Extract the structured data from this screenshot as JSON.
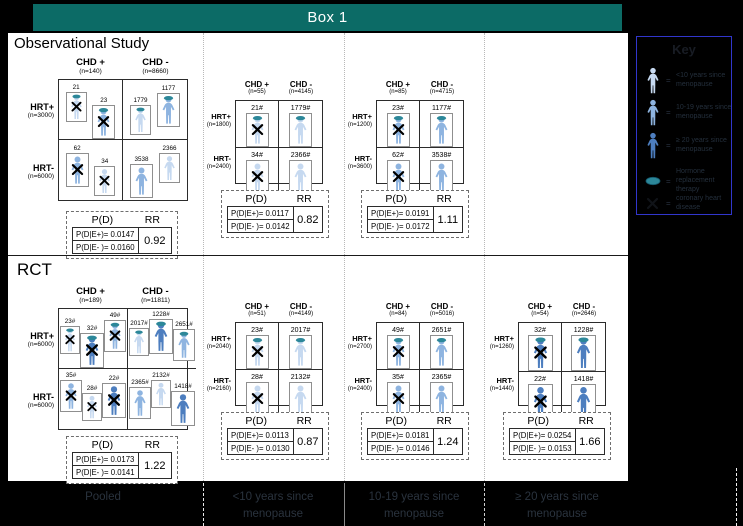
{
  "window": {
    "title": "Box 1"
  },
  "colors": {
    "header_bg": "#0c6b66",
    "person_light": "#c6d9f0",
    "person_medium": "#8eb4e0",
    "person_dark": "#4d7ebf",
    "hrt_oval": "#2c8799",
    "legend_border": "#3136cc"
  },
  "legend": {
    "title": "Key",
    "items": [
      {
        "icon": "person-light-icon",
        "shade": "light",
        "label": "<10 years since menopause"
      },
      {
        "icon": "person-medium-icon",
        "shade": "medium",
        "label": "10-19 years since menopause"
      },
      {
        "icon": "person-dark-icon",
        "shade": "dark",
        "label": "≥ 20 years since menopause"
      },
      {
        "icon": "hrt-oval-icon",
        "shade": "oval",
        "label": "Hormone replacement therapy"
      },
      {
        "icon": "chd-x-icon",
        "shade": "x",
        "label": "coronary heart disease"
      }
    ]
  },
  "sections": [
    {
      "title": "Observational Study",
      "panels": [
        {
          "columns": [
            {
              "label": "CHD +",
              "n": "(n=140)"
            },
            {
              "label": "CHD -",
              "n": "(n=8660)"
            }
          ],
          "rows": [
            {
              "label": "HRT+",
              "n": "(n=3000)"
            },
            {
              "label": "HRT-",
              "n": "(n=6000)"
            }
          ],
          "cells": [
            [
              {
                "count": "21",
                "shade": "light",
                "hat": true,
                "x": true,
                "dy": 2
              },
              {
                "count": "23",
                "shade": "medium",
                "hat": true,
                "x": true,
                "dy": 15
              }
            ],
            [
              {
                "count": "1779",
                "shade": "light",
                "hat": true,
                "x": false,
                "dy": 15
              },
              {
                "count": "1177",
                "shade": "medium",
                "hat": true,
                "x": false,
                "dy": 3
              }
            ],
            [
              {
                "count": "62",
                "shade": "medium",
                "hat": false,
                "x": true,
                "dy": 3
              },
              {
                "count": "34",
                "shade": "light",
                "hat": false,
                "x": true,
                "dy": 16
              }
            ],
            [
              {
                "count": "3538",
                "shade": "medium",
                "hat": false,
                "x": false,
                "dy": 14
              },
              {
                "count": "2366",
                "shade": "light",
                "hat": false,
                "x": false,
                "dy": 3
              }
            ]
          ],
          "table": {
            "pd": "P(D)",
            "rr": "RR",
            "row1": "P(D|E+)= 0.0147",
            "row2": "P(D|E- )= 0.0160",
            "rr_value": "0.92"
          }
        },
        {
          "columns": [
            {
              "label": "CHD +",
              "n": "(n=55)"
            },
            {
              "label": "CHD -",
              "n": "(n=4145)"
            }
          ],
          "rows": [
            {
              "label": "HRT+",
              "n": "(n=1800)"
            },
            {
              "label": "HRT-",
              "n": "(n=2400)"
            }
          ],
          "cells": [
            [
              {
                "count": "21#",
                "shade": "light",
                "hat": true,
                "x": true,
                "dy": 0
              }
            ],
            [
              {
                "count": "1779#",
                "shade": "light",
                "hat": true,
                "x": false,
                "dy": 0
              }
            ],
            [
              {
                "count": "34#",
                "shade": "light",
                "hat": false,
                "x": true,
                "dy": 0
              }
            ],
            [
              {
                "count": "2366#",
                "shade": "light",
                "hat": false,
                "x": false,
                "dy": 0
              }
            ]
          ],
          "table": {
            "pd": "P(D)",
            "rr": "RR",
            "row1": "P(D|E+)= 0.0117",
            "row2": "P(D|E- )= 0.0142",
            "rr_value": "0.82"
          }
        },
        {
          "columns": [
            {
              "label": "CHD +",
              "n": "(n=85)"
            },
            {
              "label": "CHD -",
              "n": "(n=4715)"
            }
          ],
          "rows": [
            {
              "label": "HRT+",
              "n": "(n=1200)"
            },
            {
              "label": "HRT-",
              "n": "(n=3600)"
            }
          ],
          "cells": [
            [
              {
                "count": "23#",
                "shade": "medium",
                "hat": true,
                "x": true,
                "dy": 0
              }
            ],
            [
              {
                "count": "1177#",
                "shade": "medium",
                "hat": true,
                "x": false,
                "dy": 0
              }
            ],
            [
              {
                "count": "62#",
                "shade": "medium",
                "hat": false,
                "x": true,
                "dy": 0
              }
            ],
            [
              {
                "count": "3538#",
                "shade": "medium",
                "hat": false,
                "x": false,
                "dy": 0
              }
            ]
          ],
          "table": {
            "pd": "P(D)",
            "rr": "RR",
            "row1": "P(D|E+)= 0.0191",
            "row2": "P(D|E- )= 0.0172",
            "rr_value": "1.11"
          }
        }
      ]
    },
    {
      "title": "RCT",
      "panels": [
        {
          "columns": [
            {
              "label": "CHD +",
              "n": "(n=189)"
            },
            {
              "label": "CHD -",
              "n": "(n=11811)"
            }
          ],
          "rows": [
            {
              "label": "HRT+",
              "n": "(n=6000)"
            },
            {
              "label": "HRT-",
              "n": "(n=6000)"
            }
          ],
          "cells": [
            [
              {
                "count": "23#",
                "shade": "light",
                "hat": true,
                "x": true,
                "dy": 7
              },
              {
                "count": "32#",
                "shade": "dark",
                "hat": true,
                "x": true,
                "dy": 14
              },
              {
                "count": "49#",
                "shade": "medium",
                "hat": true,
                "x": true,
                "dy": 1
              }
            ],
            [
              {
                "count": "2017#",
                "shade": "light",
                "hat": true,
                "x": false,
                "dy": 9
              },
              {
                "count": "1228#",
                "shade": "dark",
                "hat": true,
                "x": false,
                "dy": 0
              },
              {
                "count": "2651#",
                "shade": "medium",
                "hat": true,
                "x": false,
                "dy": 10
              }
            ],
            [
              {
                "count": "35#",
                "shade": "medium",
                "hat": false,
                "x": true,
                "dy": 1
              },
              {
                "count": "28#",
                "shade": "light",
                "hat": false,
                "x": true,
                "dy": 14
              },
              {
                "count": "22#",
                "shade": "dark",
                "hat": false,
                "x": true,
                "dy": 4
              }
            ],
            [
              {
                "count": "2365#",
                "shade": "medium",
                "hat": false,
                "x": false,
                "dy": 8
              },
              {
                "count": "2132#",
                "shade": "light",
                "hat": false,
                "x": false,
                "dy": 1
              },
              {
                "count": "1418#",
                "shade": "dark",
                "hat": false,
                "x": false,
                "dy": 12
              }
            ]
          ],
          "table": {
            "pd": "P(D)",
            "rr": "RR",
            "row1": "P(D|E+)= 0.0173",
            "row2": "P(D|E- )= 0.0141",
            "rr_value": "1.22"
          }
        },
        {
          "columns": [
            {
              "label": "CHD +",
              "n": "(n=51)"
            },
            {
              "label": "CHD -",
              "n": "(n=4149)"
            }
          ],
          "rows": [
            {
              "label": "HRT+",
              "n": "(n=2040)"
            },
            {
              "label": "HRT-",
              "n": "(n=2160)"
            }
          ],
          "cells": [
            [
              {
                "count": "23#",
                "shade": "light",
                "hat": true,
                "x": true,
                "dy": 0
              }
            ],
            [
              {
                "count": "2017#",
                "shade": "light",
                "hat": true,
                "x": false,
                "dy": 0
              }
            ],
            [
              {
                "count": "28#",
                "shade": "light",
                "hat": false,
                "x": true,
                "dy": 0
              }
            ],
            [
              {
                "count": "2132#",
                "shade": "light",
                "hat": false,
                "x": false,
                "dy": 0
              }
            ]
          ],
          "table": {
            "pd": "P(D)",
            "rr": "RR",
            "row1": "P(D|E+)= 0.0113",
            "row2": "P(D|E- )= 0.0130",
            "rr_value": "0.87"
          }
        },
        {
          "columns": [
            {
              "label": "CHD +",
              "n": "(n=84)"
            },
            {
              "label": "CHD -",
              "n": "(n=5016)"
            }
          ],
          "rows": [
            {
              "label": "HRT+",
              "n": "(n=2700)"
            },
            {
              "label": "HRT-",
              "n": "(n=2400)"
            }
          ],
          "cells": [
            [
              {
                "count": "49#",
                "shade": "medium",
                "hat": true,
                "x": true,
                "dy": 0
              }
            ],
            [
              {
                "count": "2651#",
                "shade": "medium",
                "hat": true,
                "x": false,
                "dy": 0
              }
            ],
            [
              {
                "count": "35#",
                "shade": "medium",
                "hat": false,
                "x": true,
                "dy": 0
              }
            ],
            [
              {
                "count": "2365#",
                "shade": "medium",
                "hat": false,
                "x": false,
                "dy": 0
              }
            ]
          ],
          "table": {
            "pd": "P(D)",
            "rr": "RR",
            "row1": "P(D|E+)= 0.0181",
            "row2": "P(D|E- )= 0.0146",
            "rr_value": "1.24"
          }
        },
        {
          "columns": [
            {
              "label": "CHD +",
              "n": "(n=54)"
            },
            {
              "label": "CHD -",
              "n": "(n=2646)"
            }
          ],
          "rows": [
            {
              "label": "HRT+",
              "n": "(n=1260)"
            },
            {
              "label": "HRT-",
              "n": "(n=1440)"
            }
          ],
          "cells": [
            [
              {
                "count": "32#",
                "shade": "dark",
                "hat": true,
                "x": true,
                "dy": 0
              }
            ],
            [
              {
                "count": "1228#",
                "shade": "dark",
                "hat": true,
                "x": false,
                "dy": 0
              }
            ],
            [
              {
                "count": "22#",
                "shade": "dark",
                "hat": false,
                "x": true,
                "dy": 0
              }
            ],
            [
              {
                "count": "1418#",
                "shade": "dark",
                "hat": false,
                "x": false,
                "dy": 0
              }
            ]
          ],
          "table": {
            "pd": "P(D)",
            "rr": "RR",
            "row1": "P(D|E+)= 0.0254",
            "row2": "P(D|E- )= 0.0153",
            "rr_value": "1.66"
          }
        }
      ]
    }
  ],
  "footer": {
    "labels": [
      "Pooled",
      "<10 years since menopause",
      "10-19 years since menopause",
      "≥ 20 years since menopause"
    ]
  }
}
